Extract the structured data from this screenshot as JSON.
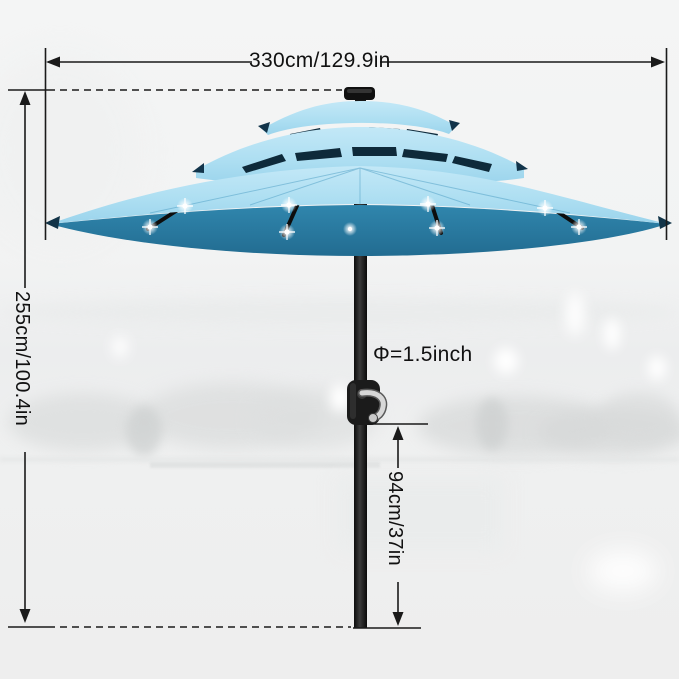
{
  "annotations": {
    "width": "330cm/129.9in",
    "height": "255cm/100.4in",
    "pole_diameter": "Φ=1.5inch",
    "crank_height": "94cm/37in"
  },
  "product": {
    "elements": [
      "three-tier-canopy",
      "solar-panel-cap",
      "led-lights",
      "tilt-crank-handle",
      "black-pole"
    ],
    "led_light_count_visible": 9,
    "tier_count": 3
  },
  "colors": {
    "canopy_top": "#aedff2",
    "canopy_top_light": "#c3e8f7",
    "canopy_underside": "#2e81a8",
    "canopy_vent_dark": "#0e2a3a",
    "pole": "#161616",
    "pole_band_silver": "#c9c9c9",
    "crank_silver": "#d8d8d8",
    "crank_red_dot": "#b03030",
    "annotation_line": "#1a1a1a",
    "annotation_text": "#111111",
    "led_glow": "#ffffff",
    "background": "#f1f2f2"
  }
}
